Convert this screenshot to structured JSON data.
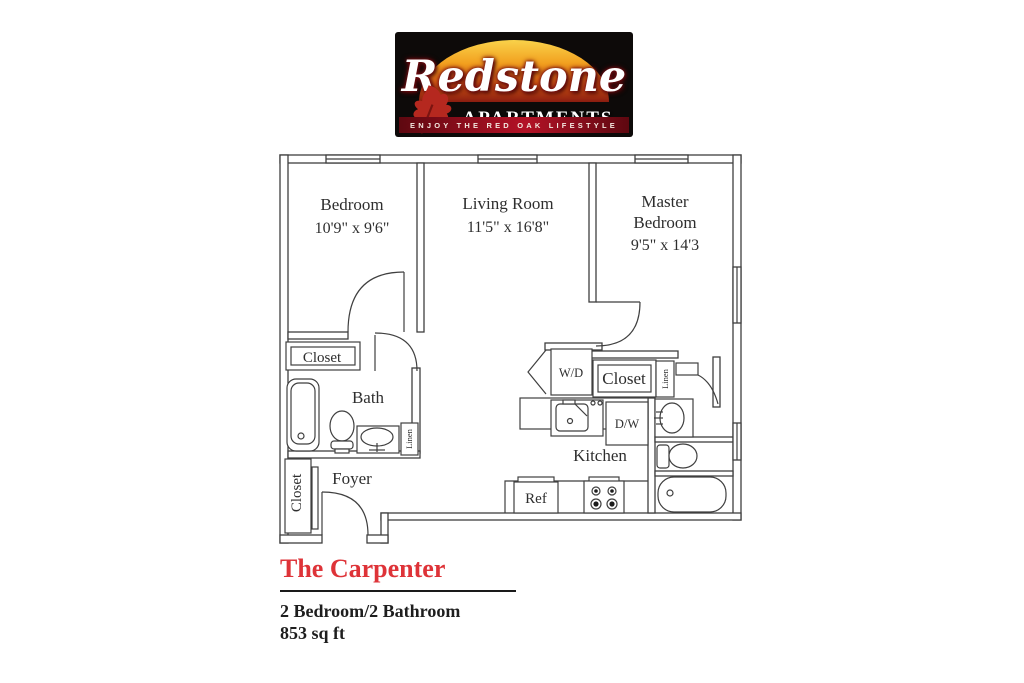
{
  "logo": {
    "brand": "Redstone",
    "brand_sub": "APARTMENTS",
    "tagline": "ENJOY THE RED OAK LIFESTYLE"
  },
  "floorplan": {
    "rooms": {
      "bedroom": {
        "name": "Bedroom",
        "dims": "10'9\" x 9'6\""
      },
      "living": {
        "name": "Living Room",
        "dims": "11'5\" x 16'8\""
      },
      "master": {
        "name_line1": "Master",
        "name_line2": "Bedroom",
        "dims": "9'5\" x 14'3"
      },
      "bath": {
        "name": "Bath"
      },
      "foyer": {
        "name": "Foyer"
      },
      "kitchen": {
        "name": "Kitchen"
      }
    },
    "labels": {
      "closet_bedroom": "Closet",
      "closet_foyer": "Closet",
      "closet_hall": "Closet",
      "linen_bath": "Linen",
      "linen_hall": "Linen",
      "washer_dryer": "W/D",
      "dishwasher": "D/W",
      "refrigerator": "Ref"
    }
  },
  "details": {
    "title": "The Carpenter",
    "config": "2 Bedroom/2 Bathroom",
    "area": "853 sq ft"
  },
  "colors": {
    "accent_red": "#de3338",
    "wall_line": "#3f3f3f",
    "logo_sunset_top": "#f9d24a",
    "logo_sunset_bottom": "#8a1c10",
    "logo_banner_red": "#a50f22",
    "logo_leaf_red": "#b5281f"
  }
}
